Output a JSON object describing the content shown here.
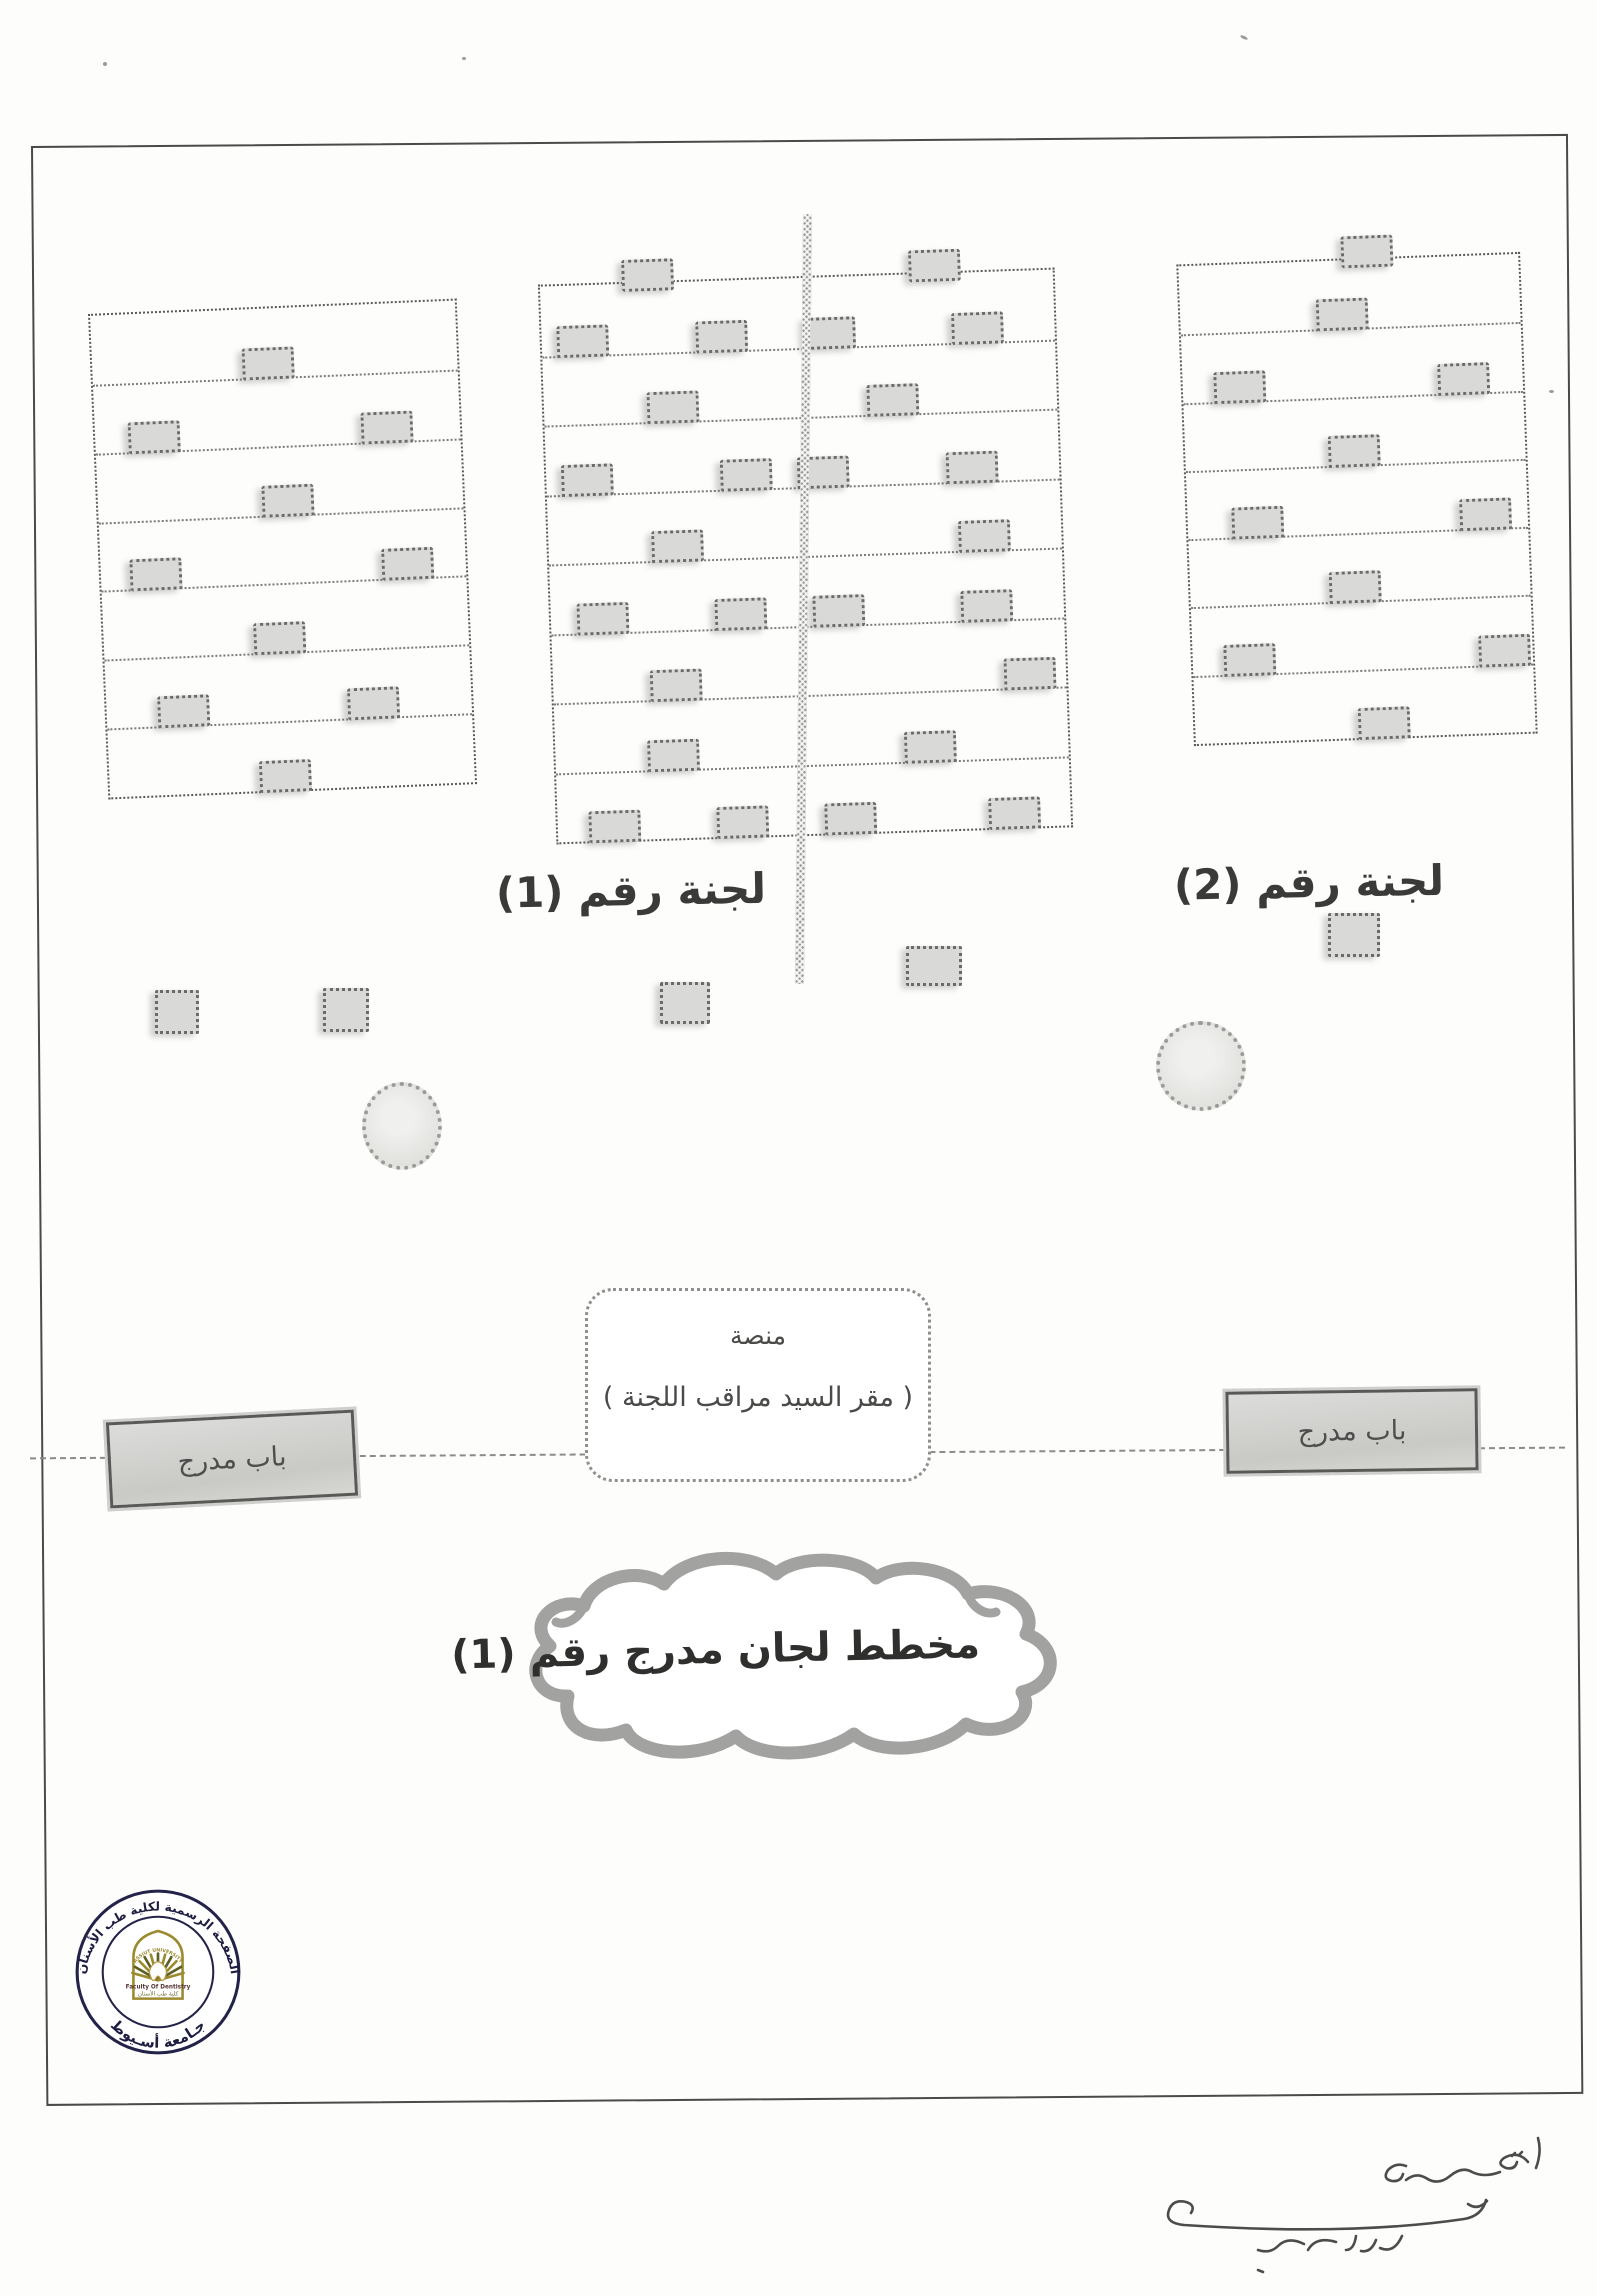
{
  "labels": {
    "committee1": "لجنة رقم (1)",
    "committee2": "لجنة رقم (2)",
    "platform_line1": "منصة",
    "platform_line2": "( مقر السيد  مراقب اللجنة )",
    "door_left": "باب مدرج",
    "door_right": "باب مدرج",
    "cloud_title": "مخطط لجان مدرج رقم (1)"
  },
  "stamp": {
    "ring_top": "الصفحة الرسمية لكلية طب الأسنان",
    "ring_bottom": "جـامعة أسـيوط",
    "arch_top": "ASSIUT UNIVERSITY",
    "arch_en": "Faculty Of Dentistry",
    "arch_ar": "كلية طب الأسنان",
    "colors": {
      "ring_navy": "#23234a",
      "gold": "#9c8a2e",
      "olive": "#5f5f23"
    }
  },
  "handwriting": {
    "description": "illegible handwritten Arabic note with signature flourish"
  },
  "colors": {
    "paper": "#fdfdfc",
    "border_ink": "#4a4a48",
    "line_gray": "#7b7b78",
    "desk_fill": "#d9d9d7",
    "desk_border": "#6a6a68",
    "door_fill": "#d2d2cf",
    "cloud_stroke": "#a2a2a0"
  },
  "seating": {
    "blocks": [
      {
        "name": "committee-1-left",
        "x": 98,
        "y": 306,
        "w": 365,
        "h": 482,
        "rot": -2.4,
        "lines": [
          0.143,
          0.286,
          0.429,
          0.571,
          0.714,
          0.857,
          1.0
        ],
        "rows": [
          {
            "line": 0.143,
            "desks": [
              41
            ]
          },
          {
            "line": 0.286,
            "desks": [
              9,
              73
            ]
          },
          {
            "line": 0.429,
            "desks": [
              45
            ]
          },
          {
            "line": 0.571,
            "desks": [
              8,
              77
            ]
          },
          {
            "line": 0.714,
            "desks": [
              41
            ]
          },
          {
            "line": 0.857,
            "desks": [
              14,
              66
            ]
          },
          {
            "line": 1.0,
            "desks": [
              41
            ]
          }
        ]
      },
      {
        "name": "center-split",
        "x": 547,
        "y": 276,
        "w": 513,
        "h": 556,
        "rot": -1.9,
        "lines": [
          0.125,
          0.25,
          0.375,
          0.5,
          0.625,
          0.75,
          0.875,
          1.0
        ],
        "rows": [
          {
            "line": 0.0,
            "desks": [
              16,
              72
            ]
          },
          {
            "line": 0.125,
            "desks": [
              3,
              30,
              51,
              80
            ]
          },
          {
            "line": 0.25,
            "desks": [
              20,
              63
            ]
          },
          {
            "line": 0.375,
            "desks": [
              3,
              34,
              49,
              78
            ]
          },
          {
            "line": 0.5,
            "desks": [
              20,
              80
            ]
          },
          {
            "line": 0.625,
            "desks": [
              5,
              32,
              51,
              80
            ]
          },
          {
            "line": 0.75,
            "desks": [
              19,
              88
            ]
          },
          {
            "line": 0.875,
            "desks": [
              18,
              68
            ]
          },
          {
            "line": 1.0,
            "desks": [
              6,
              31,
              52,
              84
            ]
          }
        ]
      },
      {
        "name": "committee-2-right",
        "x": 1185,
        "y": 258,
        "w": 340,
        "h": 478,
        "rot": -2.1,
        "lines": [
          0.143,
          0.286,
          0.429,
          0.571,
          0.714,
          0.857,
          1.0
        ],
        "rows": [
          {
            "line": 0.0,
            "desks": [
              48
            ]
          },
          {
            "line": 0.143,
            "desks": [
              40
            ]
          },
          {
            "line": 0.286,
            "desks": [
              9,
              75
            ]
          },
          {
            "line": 0.429,
            "desks": [
              42
            ]
          },
          {
            "line": 0.571,
            "desks": [
              13,
              80
            ]
          },
          {
            "line": 0.714,
            "desks": [
              41
            ]
          },
          {
            "line": 0.857,
            "desks": [
              9,
              84
            ]
          },
          {
            "line": 1.0,
            "desks": [
              48
            ]
          }
        ]
      }
    ],
    "scattered_desks": [
      {
        "x": 155,
        "y": 990,
        "w": 38,
        "h": 38
      },
      {
        "x": 323,
        "y": 988,
        "w": 40,
        "h": 38
      },
      {
        "x": 660,
        "y": 982,
        "w": 44,
        "h": 36
      },
      {
        "x": 906,
        "y": 946,
        "w": 50,
        "h": 34
      },
      {
        "x": 1328,
        "y": 913,
        "w": 46,
        "h": 38
      }
    ],
    "circles": [
      {
        "cx": 398,
        "cy": 1122,
        "rx": 36,
        "ry": 40
      },
      {
        "cx": 1197,
        "cy": 1062,
        "rx": 41,
        "ry": 41
      }
    ]
  }
}
